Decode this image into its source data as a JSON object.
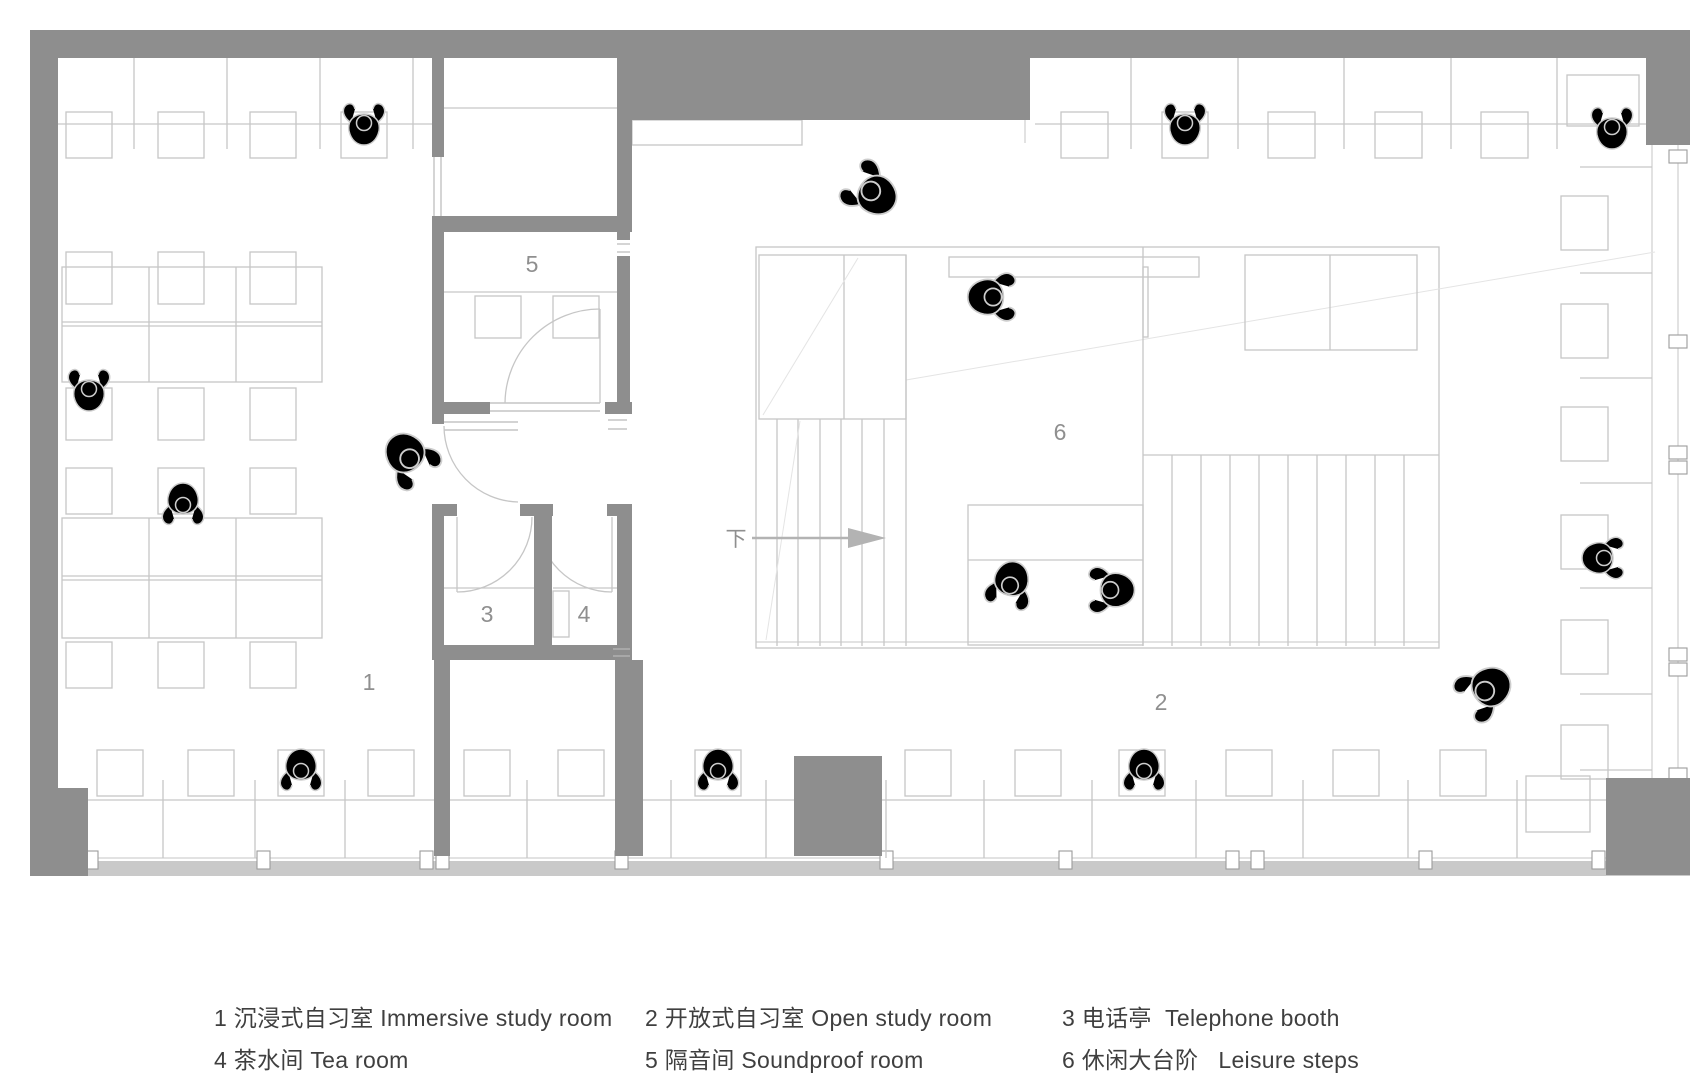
{
  "plan": {
    "room_labels": [
      {
        "text": "1",
        "name": "immersive-study-room"
      },
      {
        "text": "2",
        "name": "open-study-room"
      },
      {
        "text": "3",
        "name": "telephone-booth"
      },
      {
        "text": "4",
        "name": "tea-room"
      },
      {
        "text": "5",
        "name": "soundproof-room"
      },
      {
        "text": "6",
        "name": "leisure-steps"
      }
    ],
    "down_label": "下",
    "colors": {
      "wall": "#8e8e8e",
      "furniture": "#c6c6c6",
      "figure": "#cdcdcd",
      "label": "#8f8f8f",
      "legend_text": "#3f3f3f",
      "window_band": "#c9c9c9",
      "arrow": "#b3b3b3"
    }
  },
  "legend": {
    "items": [
      {
        "label": "1 沉浸式自习室 Immersive study room"
      },
      {
        "label": "2 开放式自习室 Open study room"
      },
      {
        "label": "3 电话亭  Telephone booth"
      },
      {
        "label": "4 茶水间 Tea room"
      },
      {
        "label": "5 隔音间 Soundproof room"
      },
      {
        "label": "6 休闲大台阶   Leisure steps"
      }
    ]
  }
}
